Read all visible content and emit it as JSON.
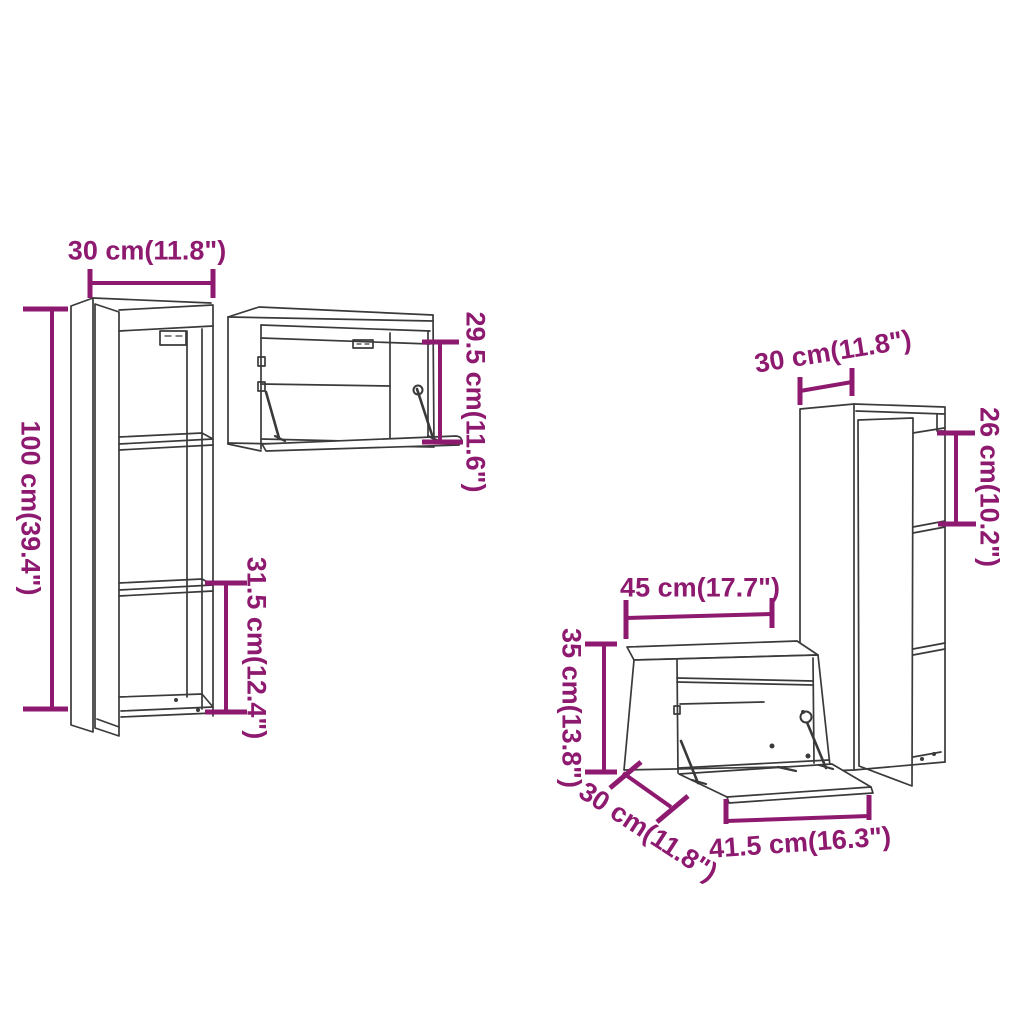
{
  "colors": {
    "dimension_text_and_lines": "#8E1A70",
    "drawing_lines": "#3A3A3A",
    "background": "#FFFFFF"
  },
  "cabinets": {
    "tall_left": {
      "width_label": "30 cm(11.8\")",
      "height_label": "100 cm(39.4\")",
      "shelf_label": "31.5 cm(12.4\")"
    },
    "horizontal_top": {
      "height_label": "29.5 cm(11.6\")"
    },
    "tall_right": {
      "width_label": "30 cm(11.8\")",
      "shelf_label": "26 cm(10.2\")"
    },
    "flap_bottom": {
      "width_label": "45 cm(17.7\")",
      "height_label": "35 cm(13.8\")",
      "depth_label": "30 cm(11.8\")",
      "flap_width_label": "41.5 cm(16.3\")"
    }
  }
}
